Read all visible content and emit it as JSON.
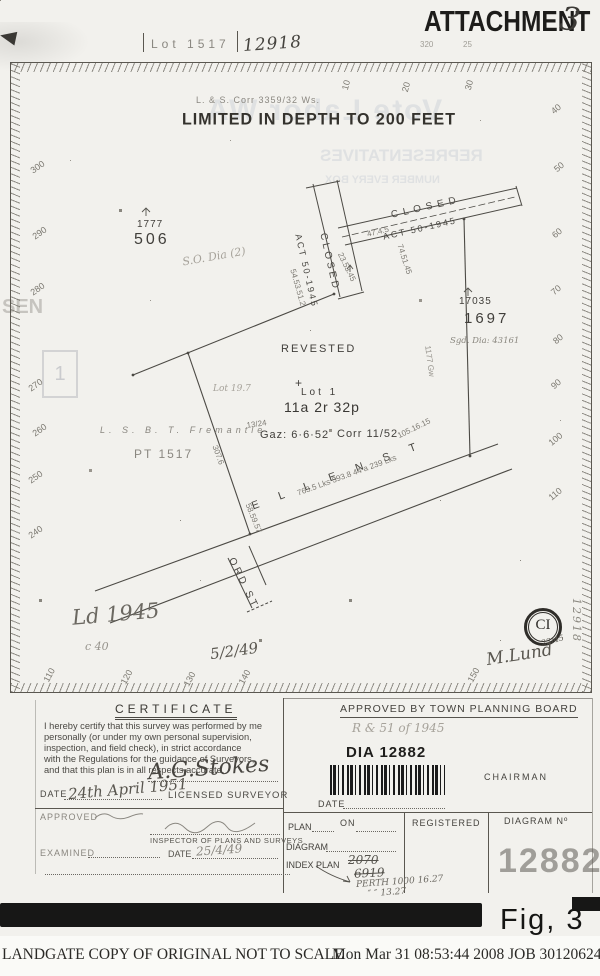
{
  "stamp": {
    "attachment": "ATTACHMENT",
    "number": "3"
  },
  "header": {
    "lot": "Lot 1517",
    "plan_no": "12918",
    "corr": "L. & S. Corr 3359/32 Ws.",
    "limited": "LIMITED IN DEPTH TO 200 FEET",
    "above1": "320",
    "above2": "25"
  },
  "plan": {
    "roads": {
      "closed1": "CLOSED",
      "act1": "ACT 50-1945",
      "closed2": "CLOSED",
      "act2": "ACT 50-1945"
    },
    "parcels": {
      "n1777": "1777",
      "n506": "506",
      "n17035": "17035",
      "n1697": "1697",
      "sgd_dia": "Sgd. Dia: 43161",
      "so_dia": "S.O. Dia (2)",
      "revested": "REVESTED",
      "cross": "+",
      "lot1": "Lot 1",
      "area": "11a 2r 32p",
      "gaz": "Gaz: 6·6·52",
      "corr": "Corr 11/52",
      "pt1517": "PT 1517",
      "fremantle": "L. S. B. T. Fremantle",
      "lot197": "Lot 19.7"
    },
    "streets": {
      "ellen": "E L L E N      S T",
      "ord": "ORD    ST"
    },
    "measurements": {
      "m1": "47.4.5",
      "m2": "23.53.45",
      "m3": "74.51.45",
      "m4": "54.53.51.2",
      "m5": "307.6",
      "m6": "105.16.15",
      "m7": "1177 Gw",
      "m8": "763.5 Lks    393.8    44 a    239 Lks",
      "m9": "58.59.57",
      "m10": "13/24"
    },
    "rulers": {
      "top": [
        "10",
        "20",
        "30"
      ],
      "left": [
        "300",
        "290",
        "280",
        "270",
        "260",
        "250",
        "240"
      ],
      "right": [
        "40",
        "50",
        "60",
        "70",
        "80",
        "90",
        "100",
        "110"
      ],
      "bottom": [
        "110",
        "120",
        "130",
        "140",
        "150"
      ]
    },
    "marks": {
      "ci": "CI"
    },
    "handwriting": {
      "ld1945": "Ld 1945",
      "c40": "c 40",
      "date5249": "5/2/49",
      "mlund": "M.Lund",
      "frac2245": "22/45",
      "margin": "12918"
    }
  },
  "certificate": {
    "heading": "CERTIFICATE",
    "body": [
      "I hereby certify that this survey was performed by me",
      "personally (or under my own personal supervision,",
      "inspection, and field check), in strict accordance",
      "with the Regulations for the guidance of Surveyors,",
      "and that this plan is in all respects accurate."
    ],
    "signature": "A.G.Stokes",
    "date_label": "DATE",
    "date_value": "24th April 1951",
    "surveyor": "LICENSED SURVEYOR"
  },
  "approval": {
    "heading": "APPROVED BY TOWN PLANNING BOARD",
    "pencil": "R & 51 of 1945",
    "dia": "DIA  12882",
    "chairman": "CHAIRMAN",
    "date_label": "DATE"
  },
  "lower": {
    "approved": "APPROVED",
    "inspector": "INSPECTOR OF PLANS AND SURVEYS",
    "examined": "EXAMINED",
    "date_label": "DATE",
    "date_value": "25/4/49",
    "plan": "PLAN",
    "on": "ON",
    "diagram": "DIAGRAM",
    "index_plan": "INDEX PLAN",
    "old1": "2070",
    "old2": "6919",
    "registered": "REGISTERED",
    "diagram_no": "DIAGRAM Nº",
    "big_number": "12882",
    "perth1": "PERTH 1000  16.27",
    "perth2": "″      ″      13.27"
  },
  "fig": "Fig, 3",
  "footer": {
    "left": "LANDGATE COPY OF ORIGINAL NOT TO SCALE",
    "right": "Mon Mar 31 08:53:44 2008 JOB 30120624"
  },
  "bleedthrough": {
    "b1": "Vote Labor WA",
    "b2": "REPRESENTATIVES",
    "b3": "NUMBER EVERY BOX",
    "b4": "SEN",
    "b5": "1"
  }
}
